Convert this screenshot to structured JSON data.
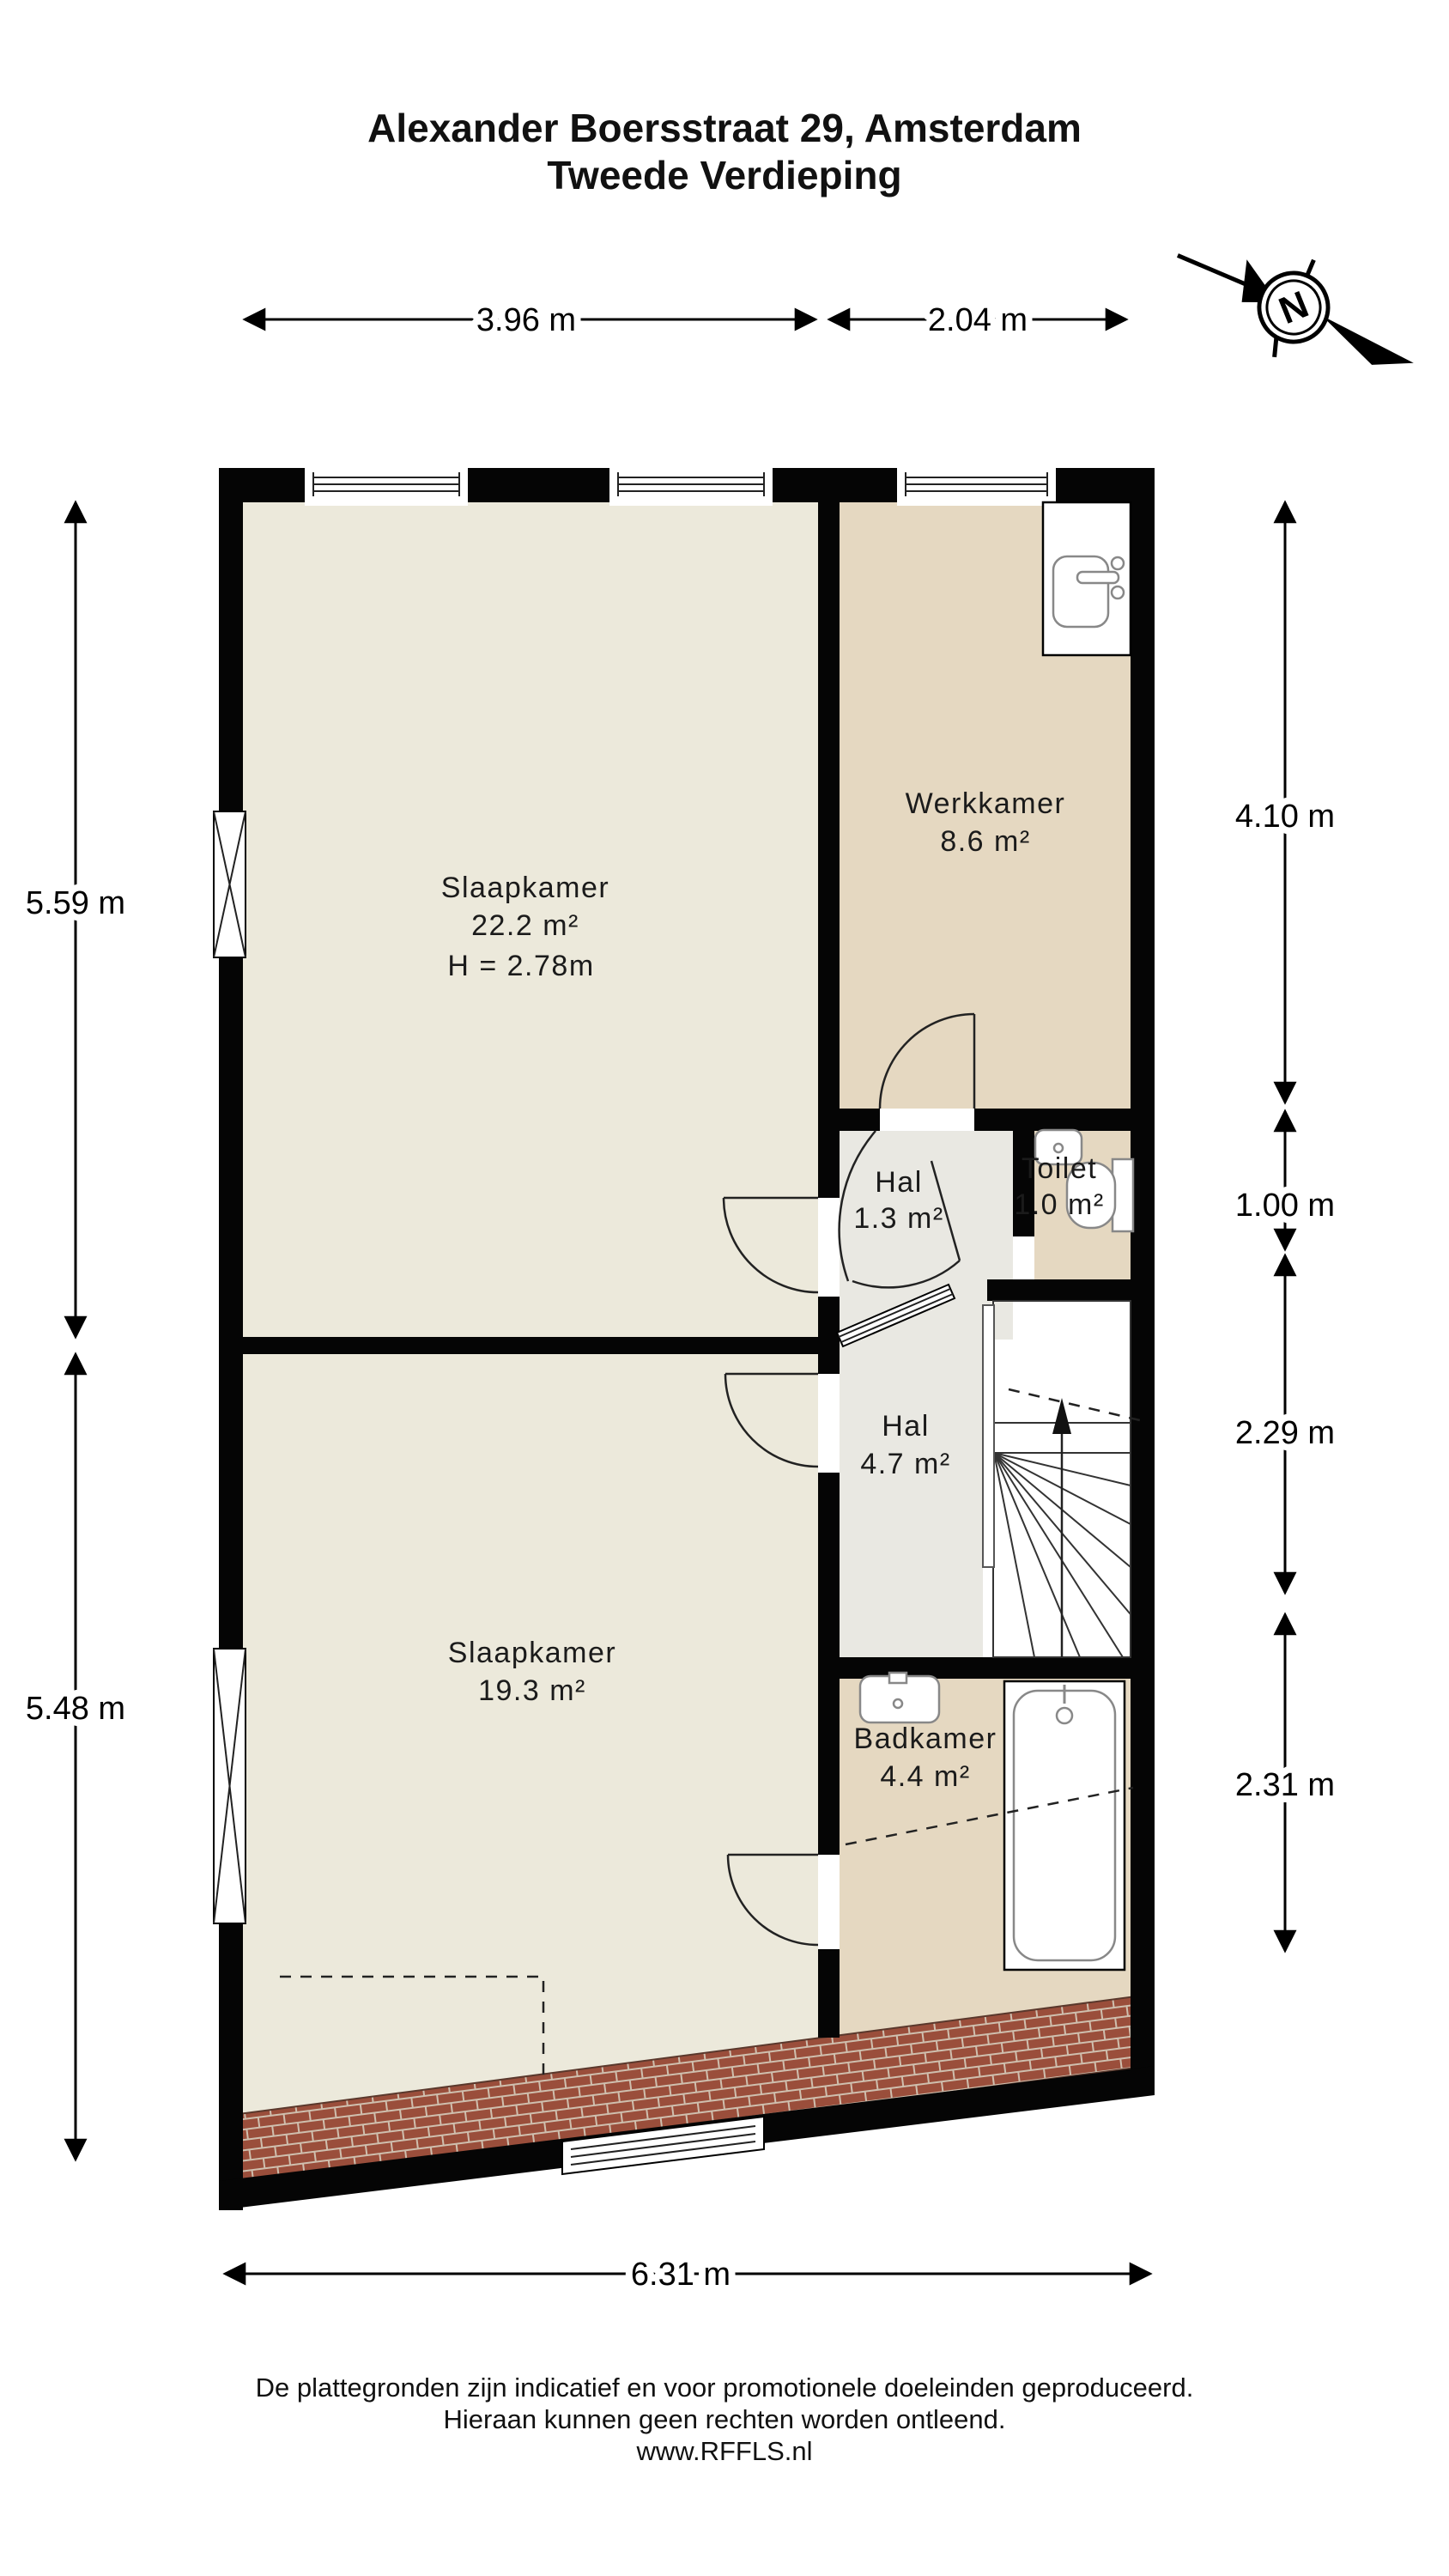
{
  "title": {
    "line1": "Alexander Boersstraat 29, Amsterdam",
    "line2": "Tweede Verdieping"
  },
  "compass": {
    "label": "N"
  },
  "dimensions": {
    "top": [
      {
        "label": "3.96 m"
      },
      {
        "label": "2.04 m"
      }
    ],
    "left": [
      {
        "label": "5.59 m"
      },
      {
        "label": "5.48 m"
      }
    ],
    "right": [
      {
        "label": "4.10 m"
      },
      {
        "label": "1.00 m"
      },
      {
        "label": "2.29 m"
      },
      {
        "label": "2.31 m"
      }
    ],
    "bottom": {
      "label": "6.31 m"
    }
  },
  "rooms": {
    "slaapkamer_boven": {
      "name": "Slaapkamer",
      "area": "22.2 m²",
      "ceiling": "H = 2.78m"
    },
    "werkkamer": {
      "name": "Werkkamer",
      "area": "8.6 m²"
    },
    "hal_klein": {
      "name": "Hal",
      "area": "1.3 m²"
    },
    "toilet": {
      "name": "Toilet",
      "area": "1.0 m²"
    },
    "hal_groot": {
      "name": "Hal",
      "area": "4.7 m²"
    },
    "slaapkamer_onder": {
      "name": "Slaapkamer",
      "area": "19.3 m²"
    },
    "badkamer": {
      "name": "Badkamer",
      "area": "4.4 m²"
    }
  },
  "footer": {
    "line1": "De plattegronden zijn indicatief en voor promotionele doeleinden geproduceerd.",
    "line2": "Hieraan kunnen geen rechten worden ontleend.",
    "line3": "www.RFFLS.nl"
  },
  "colors": {
    "wall": "#050505",
    "room_cream": "#ece9db",
    "room_tan": "#e5d8c1",
    "room_gray": "#e9e8e2",
    "brick": "#9a4e3b",
    "brick_mortar": "#cfbfae",
    "text": "#1b1b1b"
  }
}
